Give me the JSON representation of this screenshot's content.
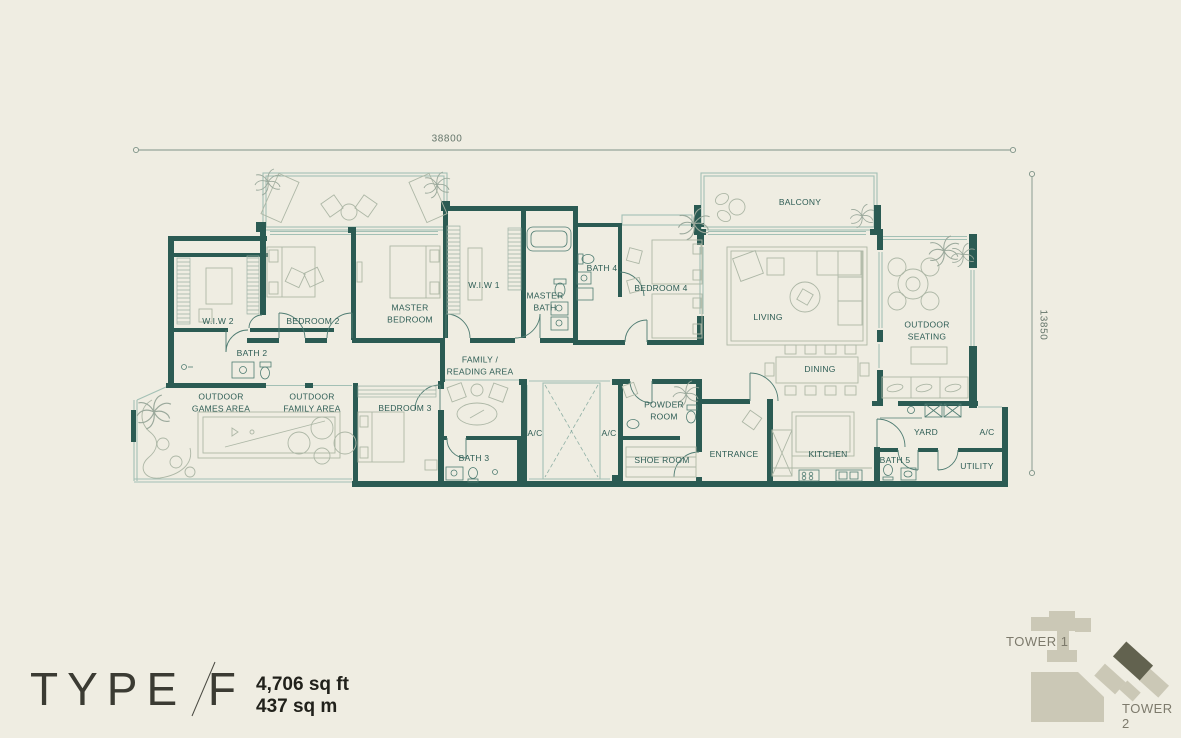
{
  "plan_title": {
    "type": "TYPE F",
    "area_sqft": "4,706 sq ft",
    "area_sqm": "437 sq m"
  },
  "dimensions": {
    "width": "38800",
    "height": "13850"
  },
  "site": {
    "tower1": "TOWER 1",
    "tower2": "TOWER 2"
  },
  "colors": {
    "background": "#EFEDE2",
    "wall": "#2B5B53",
    "label": "#2E5D55",
    "window_line": "#A3C0B5",
    "furniture_line": "#ADB7A6",
    "tower_light": "#CBC8B6",
    "tower_dark": "#62624F"
  },
  "rooms": [
    {
      "id": "balcony",
      "label": "BALCONY",
      "x": 800,
      "y": 202
    },
    {
      "id": "wiw2",
      "label": "W.I.W 2",
      "x": 218,
      "y": 321
    },
    {
      "id": "bedroom2",
      "label": "BEDROOM 2",
      "x": 313,
      "y": 321
    },
    {
      "id": "master-bedroom",
      "label": "MASTER\nBEDROOM",
      "x": 410,
      "y": 314
    },
    {
      "id": "wiw1",
      "label": "W.I.W 1",
      "x": 484,
      "y": 285
    },
    {
      "id": "master-bath",
      "label": "MASTER\nBATH",
      "x": 545,
      "y": 302
    },
    {
      "id": "bath4",
      "label": "BATH 4",
      "x": 602,
      "y": 268
    },
    {
      "id": "bedroom4",
      "label": "BEDROOM 4",
      "x": 661,
      "y": 288
    },
    {
      "id": "living",
      "label": "LIVING",
      "x": 768,
      "y": 317
    },
    {
      "id": "outdoor-seating",
      "label": "OUTDOOR\nSEATING",
      "x": 927,
      "y": 331
    },
    {
      "id": "dining",
      "label": "DINING",
      "x": 820,
      "y": 369
    },
    {
      "id": "bath2",
      "label": "BATH 2",
      "x": 252,
      "y": 353
    },
    {
      "id": "outdoor-games",
      "label": "OUTDOOR\nGAMES AREA",
      "x": 221,
      "y": 403
    },
    {
      "id": "outdoor-family",
      "label": "OUTDOOR\nFAMILY AREA",
      "x": 312,
      "y": 403
    },
    {
      "id": "bedroom3",
      "label": "BEDROOM 3",
      "x": 405,
      "y": 408
    },
    {
      "id": "family-reading",
      "label": "FAMILY /\nREADING AREA",
      "x": 480,
      "y": 366
    },
    {
      "id": "ac-left",
      "label": "A/C",
      "x": 535,
      "y": 433
    },
    {
      "id": "ac-right",
      "label": "A/C",
      "x": 609,
      "y": 433
    },
    {
      "id": "powder-room",
      "label": "POWDER\nROOM",
      "x": 664,
      "y": 411
    },
    {
      "id": "shoe-room",
      "label": "SHOE ROOM",
      "x": 662,
      "y": 460
    },
    {
      "id": "entrance",
      "label": "ENTRANCE",
      "x": 734,
      "y": 454
    },
    {
      "id": "kitchen",
      "label": "KITCHEN",
      "x": 828,
      "y": 454
    },
    {
      "id": "yard",
      "label": "YARD",
      "x": 926,
      "y": 432
    },
    {
      "id": "ac-yard",
      "label": "A/C",
      "x": 987,
      "y": 432
    },
    {
      "id": "bath5",
      "label": "BATH 5",
      "x": 895,
      "y": 460
    },
    {
      "id": "utility",
      "label": "UTILITY",
      "x": 977,
      "y": 466
    },
    {
      "id": "bath3",
      "label": "BATH 3",
      "x": 474,
      "y": 458
    }
  ]
}
